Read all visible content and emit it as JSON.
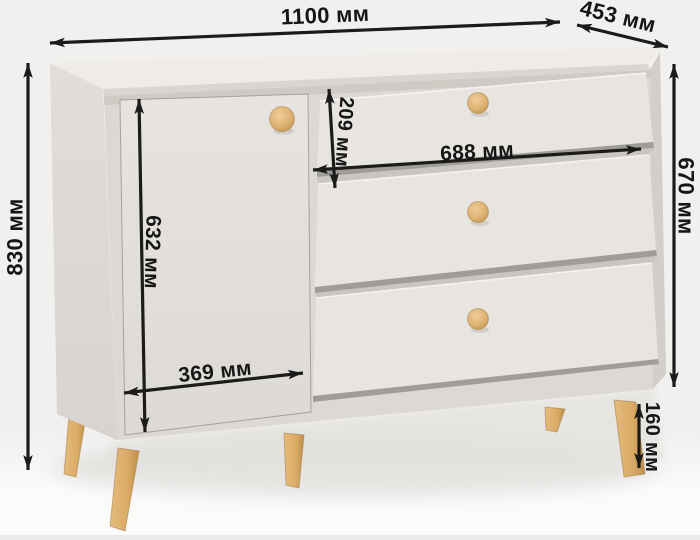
{
  "dims": {
    "width": "1100 мм",
    "depth": "453 мм",
    "height": "830 мм",
    "body_height": "670 мм",
    "leg_height": "160 мм",
    "drawer_height": "209 мм",
    "drawer_width": "688 мм",
    "door_height": "632 мм",
    "door_width": "369 мм"
  },
  "furniture": {
    "doors": 1,
    "drawers": 3,
    "knobs": 4,
    "legs_visible": 5
  },
  "colors": {
    "background": "#f1f0ee",
    "floor": "#fbfbfa",
    "top_face": "#efece7",
    "top_edge": "#d9d5d0",
    "side_face": "#e1ddd8",
    "body": "#dcd8d3",
    "right_side": "#d2cec9",
    "door_face": "#e7e4df",
    "drawer_face": "#e8e5e0",
    "recess": "#c9c5c0",
    "drawer_shadow": "#a09c97",
    "wood": "#dcae6c",
    "wood_dark": "#c6974f",
    "dimension_line": "#1b1b1b"
  }
}
